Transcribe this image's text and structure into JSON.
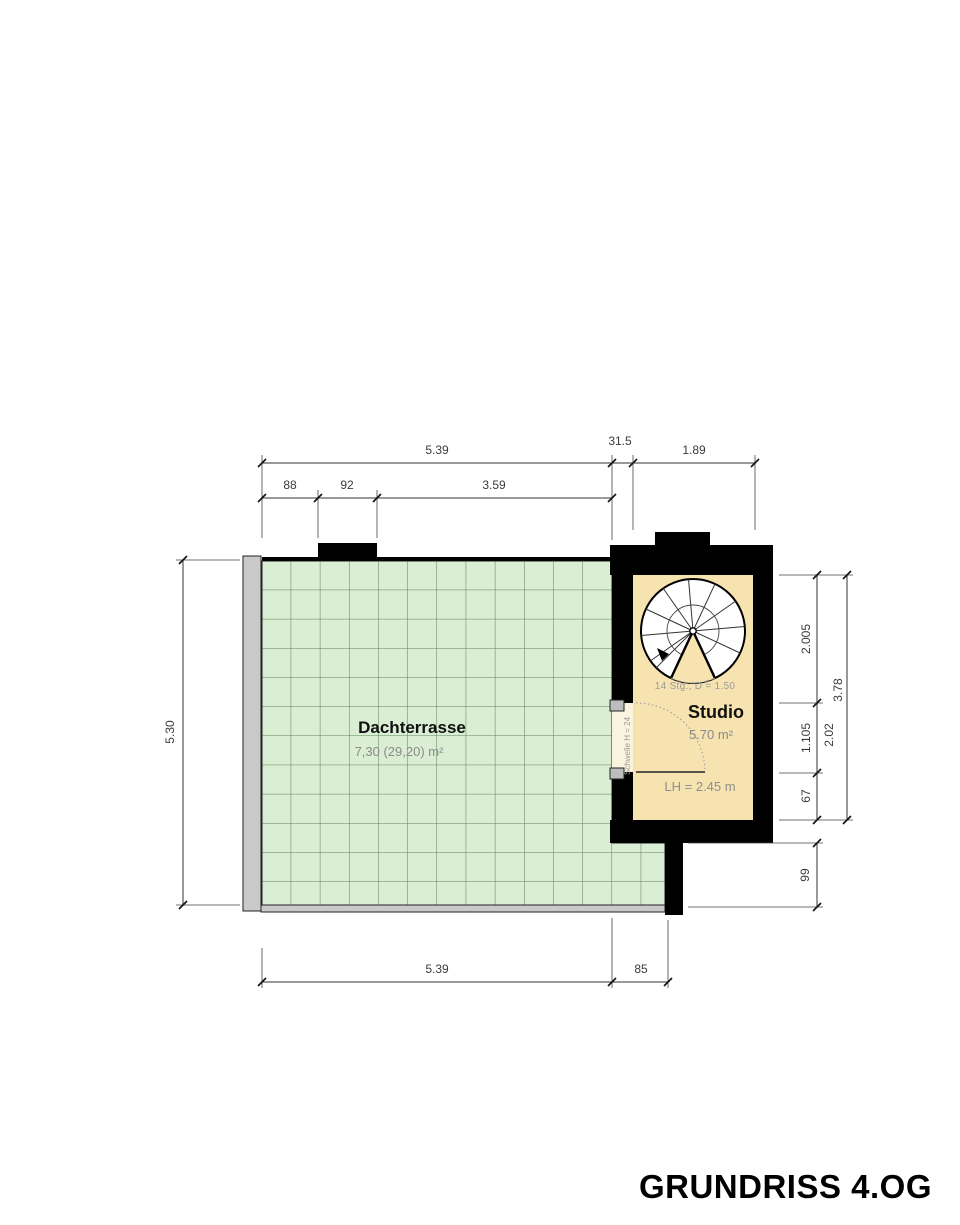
{
  "title": "GRUNDRISS 4.OG",
  "rooms": {
    "terrace": {
      "name": "Dachterrasse",
      "area": "7,30 (29,20) m²"
    },
    "studio": {
      "name": "Studio",
      "area": "5.70 m²",
      "clear_height": "LH = 2.45 m",
      "door_note": "Schwelle H = 24"
    },
    "staircase": {
      "note": "14 Stg., D = 1.50"
    }
  },
  "dimensions": {
    "top": {
      "total_width": "5.39",
      "wall": "31.5",
      "studio_width": "1.89",
      "seg1": "88",
      "seg2": "92",
      "seg3": "3.59"
    },
    "left": {
      "terrace_depth": "5.30"
    },
    "right": {
      "seg1": "2.005",
      "seg2": "1.105",
      "seg3": "67",
      "inner": "2.02",
      "total": "3.78",
      "lower": "99"
    },
    "bottom": {
      "terrace_width": "5.39",
      "extension": "85"
    }
  },
  "colors": {
    "wall": "#000000",
    "terrace_fill": "#d9eed3",
    "terrace_grid": "#5c7d5c",
    "studio_fill": "#f7e3b0",
    "door_gap_fill": "#faf3dd",
    "railing_fill": "#c9c9c9",
    "dimension": "#333333"
  }
}
